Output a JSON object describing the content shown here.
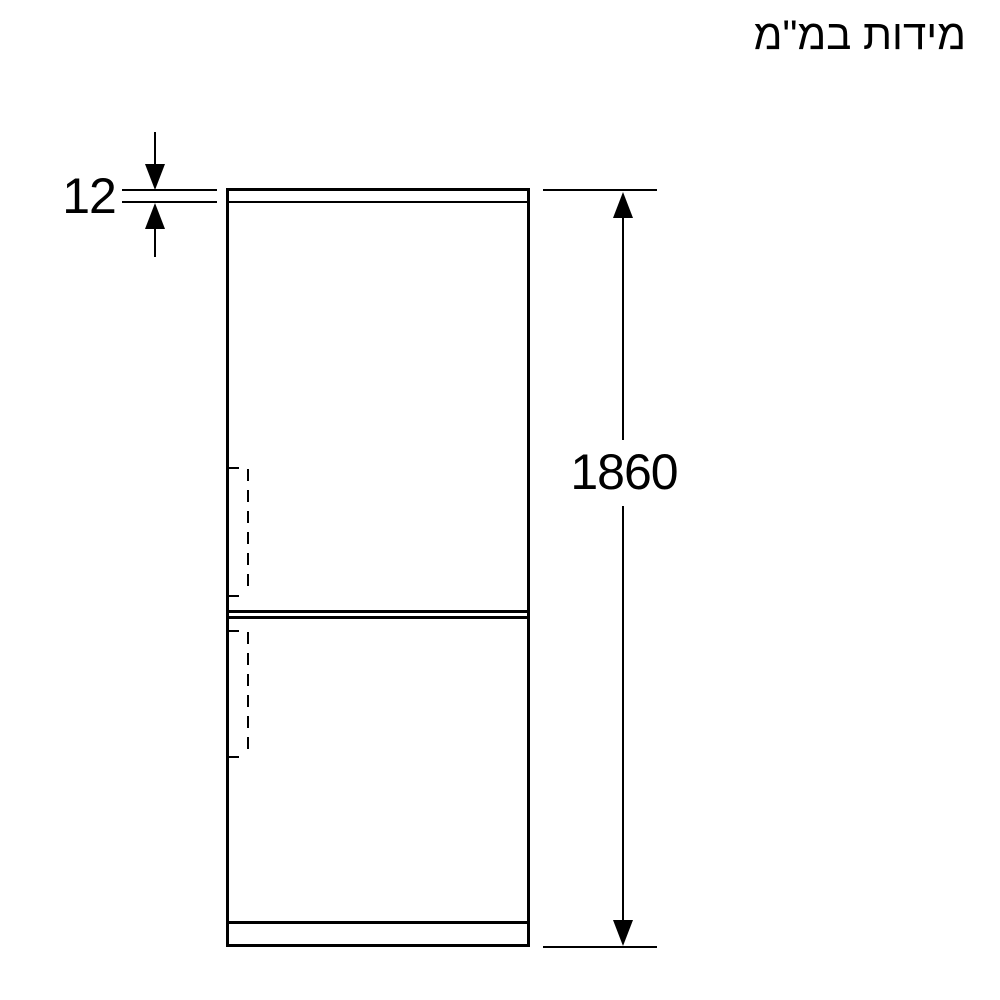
{
  "title": "מידות במ\"מ",
  "dimensions": {
    "top_panel": {
      "label": "12",
      "value": 12,
      "unit": "mm"
    },
    "overall_height": {
      "label": "1860",
      "value": 1860,
      "unit": "mm"
    }
  },
  "icons": {
    "arrow_up": "dimension arrowhead pointing up",
    "arrow_down": "dimension arrowhead pointing down"
  },
  "colors": {
    "line": "#000000",
    "background": "#ffffff"
  }
}
